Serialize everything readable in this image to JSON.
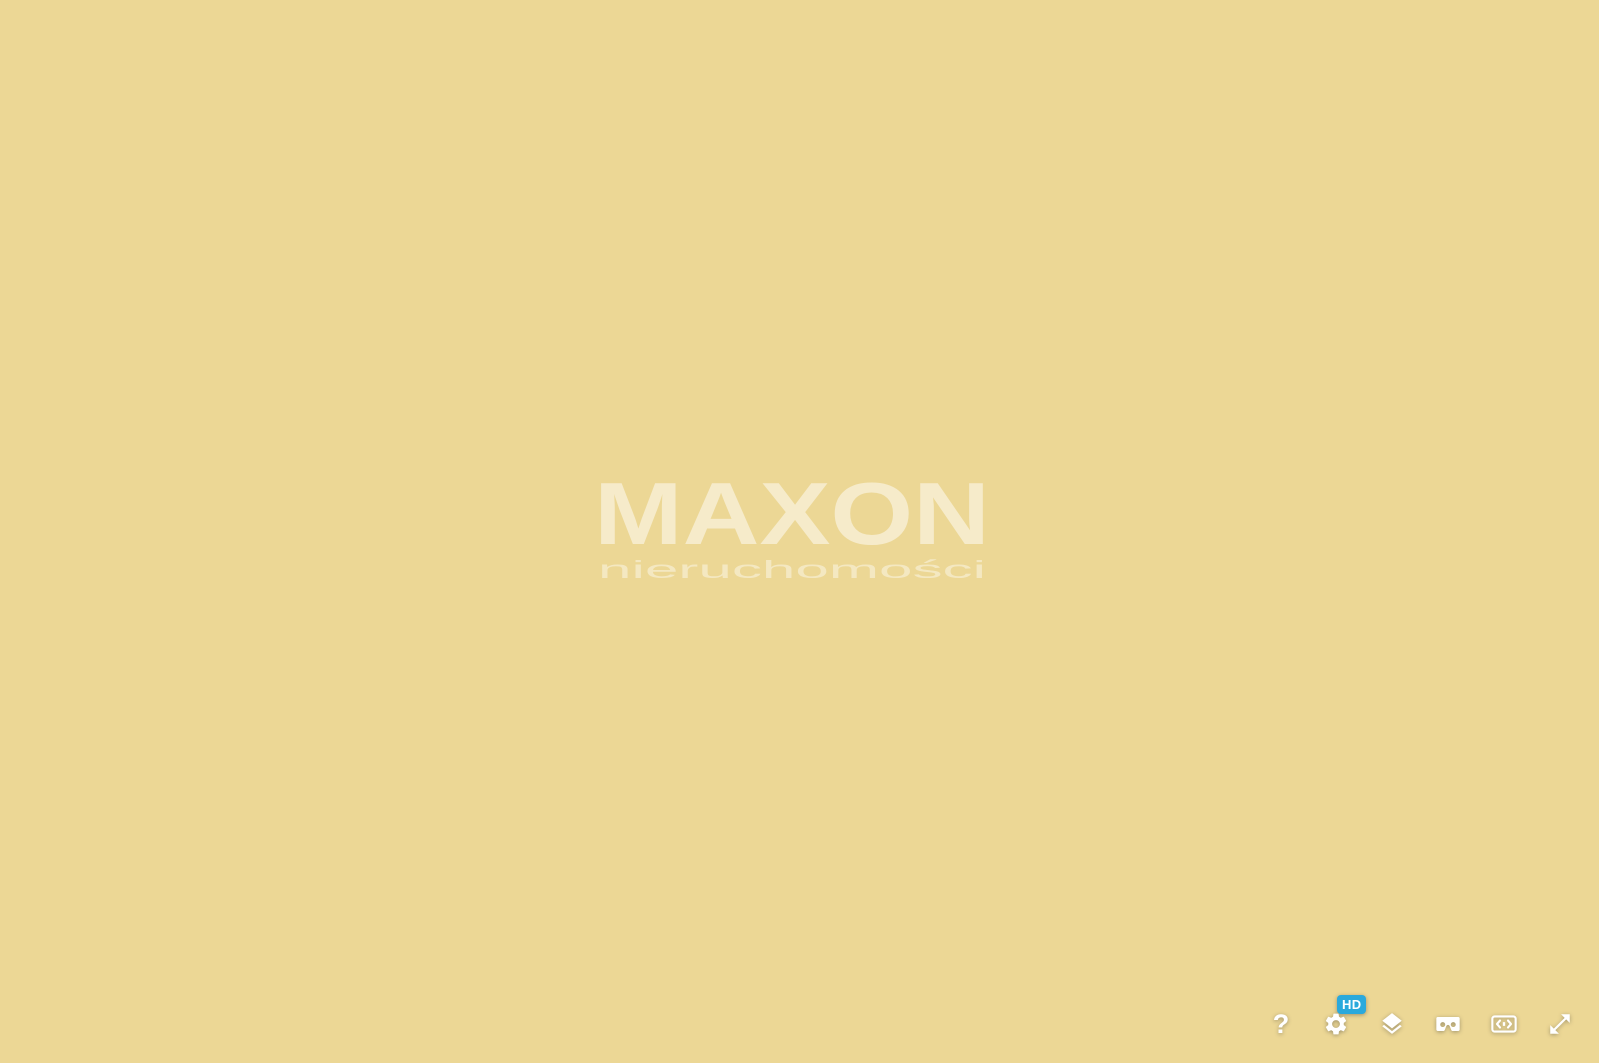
{
  "viewer": {
    "watermark": {
      "brand": "MAXON",
      "tagline": "nieruchomości"
    },
    "toolbar": {
      "help_label": "?",
      "hd_badge": "HD",
      "buttons": [
        {
          "id": "help",
          "icon": "question-mark-icon"
        },
        {
          "id": "settings",
          "icon": "gear-icon",
          "badge": "HD"
        },
        {
          "id": "layers",
          "icon": "layers-icon"
        },
        {
          "id": "vr",
          "icon": "vr-goggles-icon"
        },
        {
          "id": "pan",
          "icon": "screen-pan-icon"
        },
        {
          "id": "fullscreen",
          "icon": "fullscreen-arrows-icon"
        }
      ]
    }
  },
  "scene": {
    "type": "aerial-3d-architectural-visualization",
    "subject": "Seaside resort development: rows of gabled cabins with turquoise glass fronts, five flat-roof villas with hedge-lined gardens, beach huts, sports pitch, apartment block, sandy beach and sea",
    "colors": {
      "grass": "#8CA457",
      "grassBand": "#7B9650",
      "grassZone": "#96AC5E",
      "grassLowLeft": "#87A054",
      "gardenA": "#9DB261",
      "gardenB": "#A9BD6E",
      "cypress": "#4E6C3B",
      "cypress2": "#5A783F",
      "cypress3": "#66854A",
      "cypress4": "#71904F",
      "treeRound": "#A9BF6B",
      "treeHi": "#C2D488",
      "bush": "#7E9C52",
      "bushSmall": "#93AF5B",
      "trunk": "#8A7A5E",
      "road": "#4C4B49",
      "roadDash": "#D8D7D2",
      "pathBrown": "#9B7250",
      "fence": "#5E5E58",
      "pavement": "#EAE7DF",
      "laneLine": "#CBC8BE",
      "parking": "#4F4D4A",
      "parkStripe": "#3C3A38",
      "sand": "#ECD795",
      "sandLight": "#F5E8B8",
      "sandDark": "#E0C987",
      "wetSand": "#DBC88E",
      "sea": "#A7BCB0",
      "seaLight": "#B3C4B8",
      "seaDeep": "#9BB2A6",
      "foam": "#D7E4DA",
      "cabinRoofL": "#413E3B",
      "cabinRoofR": "#575350",
      "cabinWhite": "#F1F0EC",
      "poolLight": "#93DBDE",
      "poolDark": "#62C6CB",
      "whiteRoof": "#454240",
      "whiteFace": "#E9E6DD",
      "stripe": "#CBC8BE",
      "glass": "#9ED6D6",
      "villaRoof": "#4F4B51",
      "villaRoofHi": "#5E5A62",
      "villaWall": "#E9E7E1",
      "villaUpper": "#DCDAD2",
      "deck": "#C9A87D",
      "pad": "#B8B4AB",
      "hedgeBright": "#7FAE4C",
      "hedgeDark": "#5E7B40",
      "white": "#EFEEEA",
      "skylight": "#DACEB1",
      "skylight2": "#C9B694",
      "field": "#5F7F4C",
      "fieldLine": "#E8E8E0",
      "building": "#ECEBE6",
      "buildingLine": "#BBB9B4",
      "buildingEdge": "#5A5754",
      "buildingGlass": "#BFE0DA",
      "buildingHedge": "#4E6B3C",
      "hd": "#2AA9DC",
      "watermark": "#FFFFFF"
    }
  }
}
